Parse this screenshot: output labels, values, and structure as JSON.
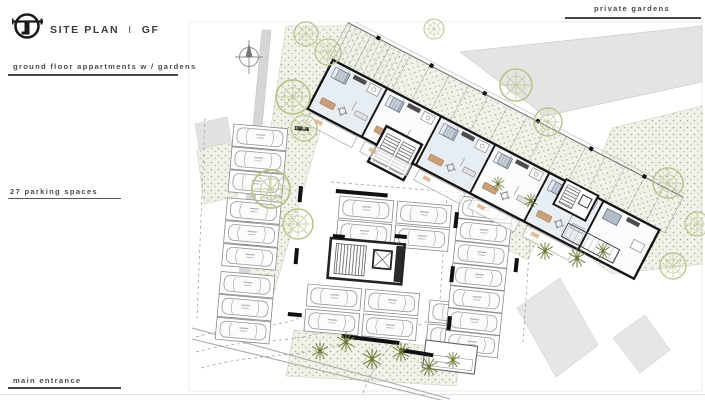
{
  "slide": {
    "title": {
      "main": "SITE PLAN",
      "separator": "I",
      "suffix": "GF"
    },
    "subtitle": "ground floor appartments w / gardens",
    "labels": {
      "private_gardens": "private gardens",
      "parking": "27 parking spaces",
      "main_entrance": "main entrance"
    }
  },
  "plan": {
    "colors": {
      "wall": "#161616",
      "interior_tint": "#e7eef3",
      "garden_stipple": "#9caf85",
      "tree_outline": "#b9c48b",
      "shrub_olive": "#7c8142",
      "context_gray": "#e4e4e4",
      "furniture_tan": "#c9a078"
    }
  }
}
